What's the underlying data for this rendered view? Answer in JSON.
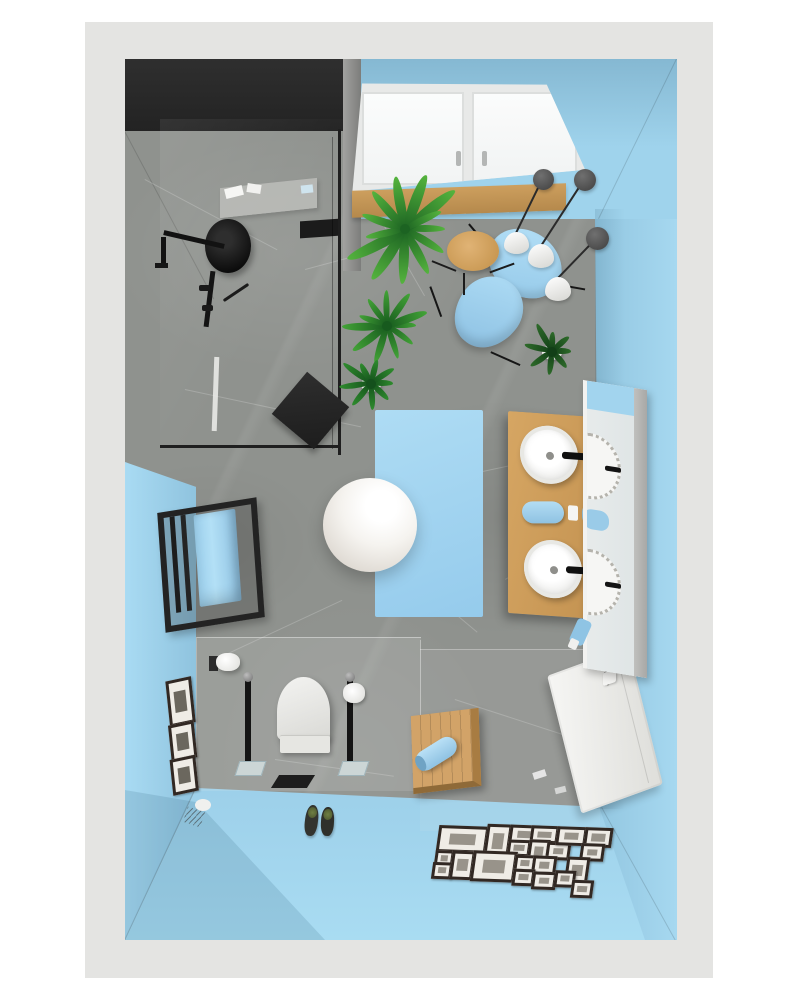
{
  "scene": {
    "description": "Top-down 3D interior render of a small bathroom",
    "view": "bird's-eye floor plan render",
    "room": "bathroom"
  },
  "palette": {
    "page_background": "#ffffff",
    "matte_border": "#e4e4e2",
    "wall_blue": "#9fd3ec",
    "wall_dark": "#282828",
    "floor_marble_gray": "#8f928e",
    "wood": "#cf9f60",
    "accent_blue": "#a8d8f2",
    "fixture_black": "#1c1c1c",
    "white_fixture": "#f4f4f2",
    "plant_green": "#3f9b3a",
    "pendant_gray": "#5a5a5a",
    "mirror_frame_gray": "#b3b3b1"
  },
  "objects": [
    "rain-shower-head",
    "shower-arm",
    "shower-valves",
    "glass-partition",
    "shower-shelf",
    "shower-stool",
    "towel-radiator",
    "blue-towels",
    "toilet",
    "toilet-brush-stand",
    "toilet-paper-stand",
    "toilet-paper-holder",
    "slippers",
    "wooden-bench",
    "rolled-towel",
    "white-radiator",
    "light-switch",
    "double-sink-vanity",
    "vessel-sinks",
    "black-faucets",
    "rolled-towels",
    "mirror",
    "bath-rug",
    "sphere-lamp",
    "lounge-chair",
    "pendant-lamps",
    "wooden-side-table",
    "potted-plants",
    "tilt-window",
    "window-sill",
    "gallery-wall",
    "wall-picture-frames"
  ],
  "gallery": {
    "frames": [
      [
        2,
        3,
        44,
        21
      ],
      [
        50,
        0,
        19,
        29
      ],
      [
        73,
        0,
        23,
        13
      ],
      [
        73,
        15,
        17,
        11
      ],
      [
        94,
        0,
        22,
        12
      ],
      [
        94,
        14,
        15,
        20
      ],
      [
        112,
        16,
        18,
        12
      ],
      [
        120,
        0,
        24,
        13
      ],
      [
        148,
        0,
        22,
        14
      ],
      [
        146,
        16,
        18,
        12
      ],
      [
        2,
        28,
        13,
        10
      ],
      [
        1,
        40,
        14,
        11
      ],
      [
        19,
        28,
        17,
        23
      ],
      [
        40,
        27,
        38,
        25
      ],
      [
        82,
        30,
        15,
        11
      ],
      [
        100,
        30,
        18,
        13
      ],
      [
        134,
        30,
        17,
        21
      ],
      [
        82,
        44,
        16,
        11
      ],
      [
        102,
        46,
        18,
        12
      ],
      [
        124,
        44,
        15,
        11
      ],
      [
        142,
        53,
        16,
        12
      ]
    ]
  },
  "wall_frames": [
    [
      2,
      0,
      20,
      40
    ],
    [
      0,
      44,
      20,
      31
    ],
    [
      -2,
      78,
      20,
      30
    ]
  ],
  "pendants": {
    "discs": [
      [
        408,
        110,
        21
      ],
      [
        449,
        110,
        22
      ],
      [
        461,
        168,
        23
      ]
    ],
    "cones": [
      [
        379,
        173,
        25,
        22
      ],
      [
        403,
        185,
        26,
        24
      ],
      [
        420,
        218,
        26,
        24
      ]
    ],
    "cords": [
      [
        418,
        121,
        60,
        116
      ],
      [
        460,
        121,
        80,
        123
      ],
      [
        472,
        180,
        58,
        134
      ]
    ]
  },
  "plants": [
    {
      "cx": 280,
      "cy": 170,
      "leaves": 13,
      "len": 56,
      "dark": "#1c6322",
      "light": "#55b43e",
      "pot": false
    },
    {
      "cx": 262,
      "cy": 267,
      "leaves": 11,
      "len": 40,
      "dark": "#175a1e",
      "light": "#43a437",
      "pot": false
    },
    {
      "cx": 246,
      "cy": 325,
      "leaves": 9,
      "len": 30,
      "dark": "#14501c",
      "light": "#2f8c2e",
      "pot": true
    },
    {
      "cx": 427,
      "cy": 293,
      "leaves": 8,
      "len": 27,
      "dark": "#123f17",
      "light": "#2e6b2a",
      "pot": true
    }
  ],
  "veins": [
    [
      20,
      120,
      150,
      28
    ],
    [
      180,
      210,
      120,
      -15
    ],
    [
      60,
      330,
      180,
      12
    ],
    [
      230,
      470,
      160,
      40
    ],
    [
      90,
      600,
      140,
      -25
    ],
    [
      330,
      640,
      170,
      18
    ],
    [
      150,
      700,
      120,
      8
    ],
    [
      380,
      520,
      90,
      -30
    ],
    [
      250,
      150,
      100,
      60
    ],
    [
      320,
      420,
      110,
      -12
    ]
  ],
  "seams": [
    [
      0,
      72,
      190,
      62
    ],
    [
      552,
      0,
      178,
      116
    ],
    [
      477,
      748,
      153,
      61
    ],
    [
      71,
      729,
      168,
      115
    ]
  ]
}
